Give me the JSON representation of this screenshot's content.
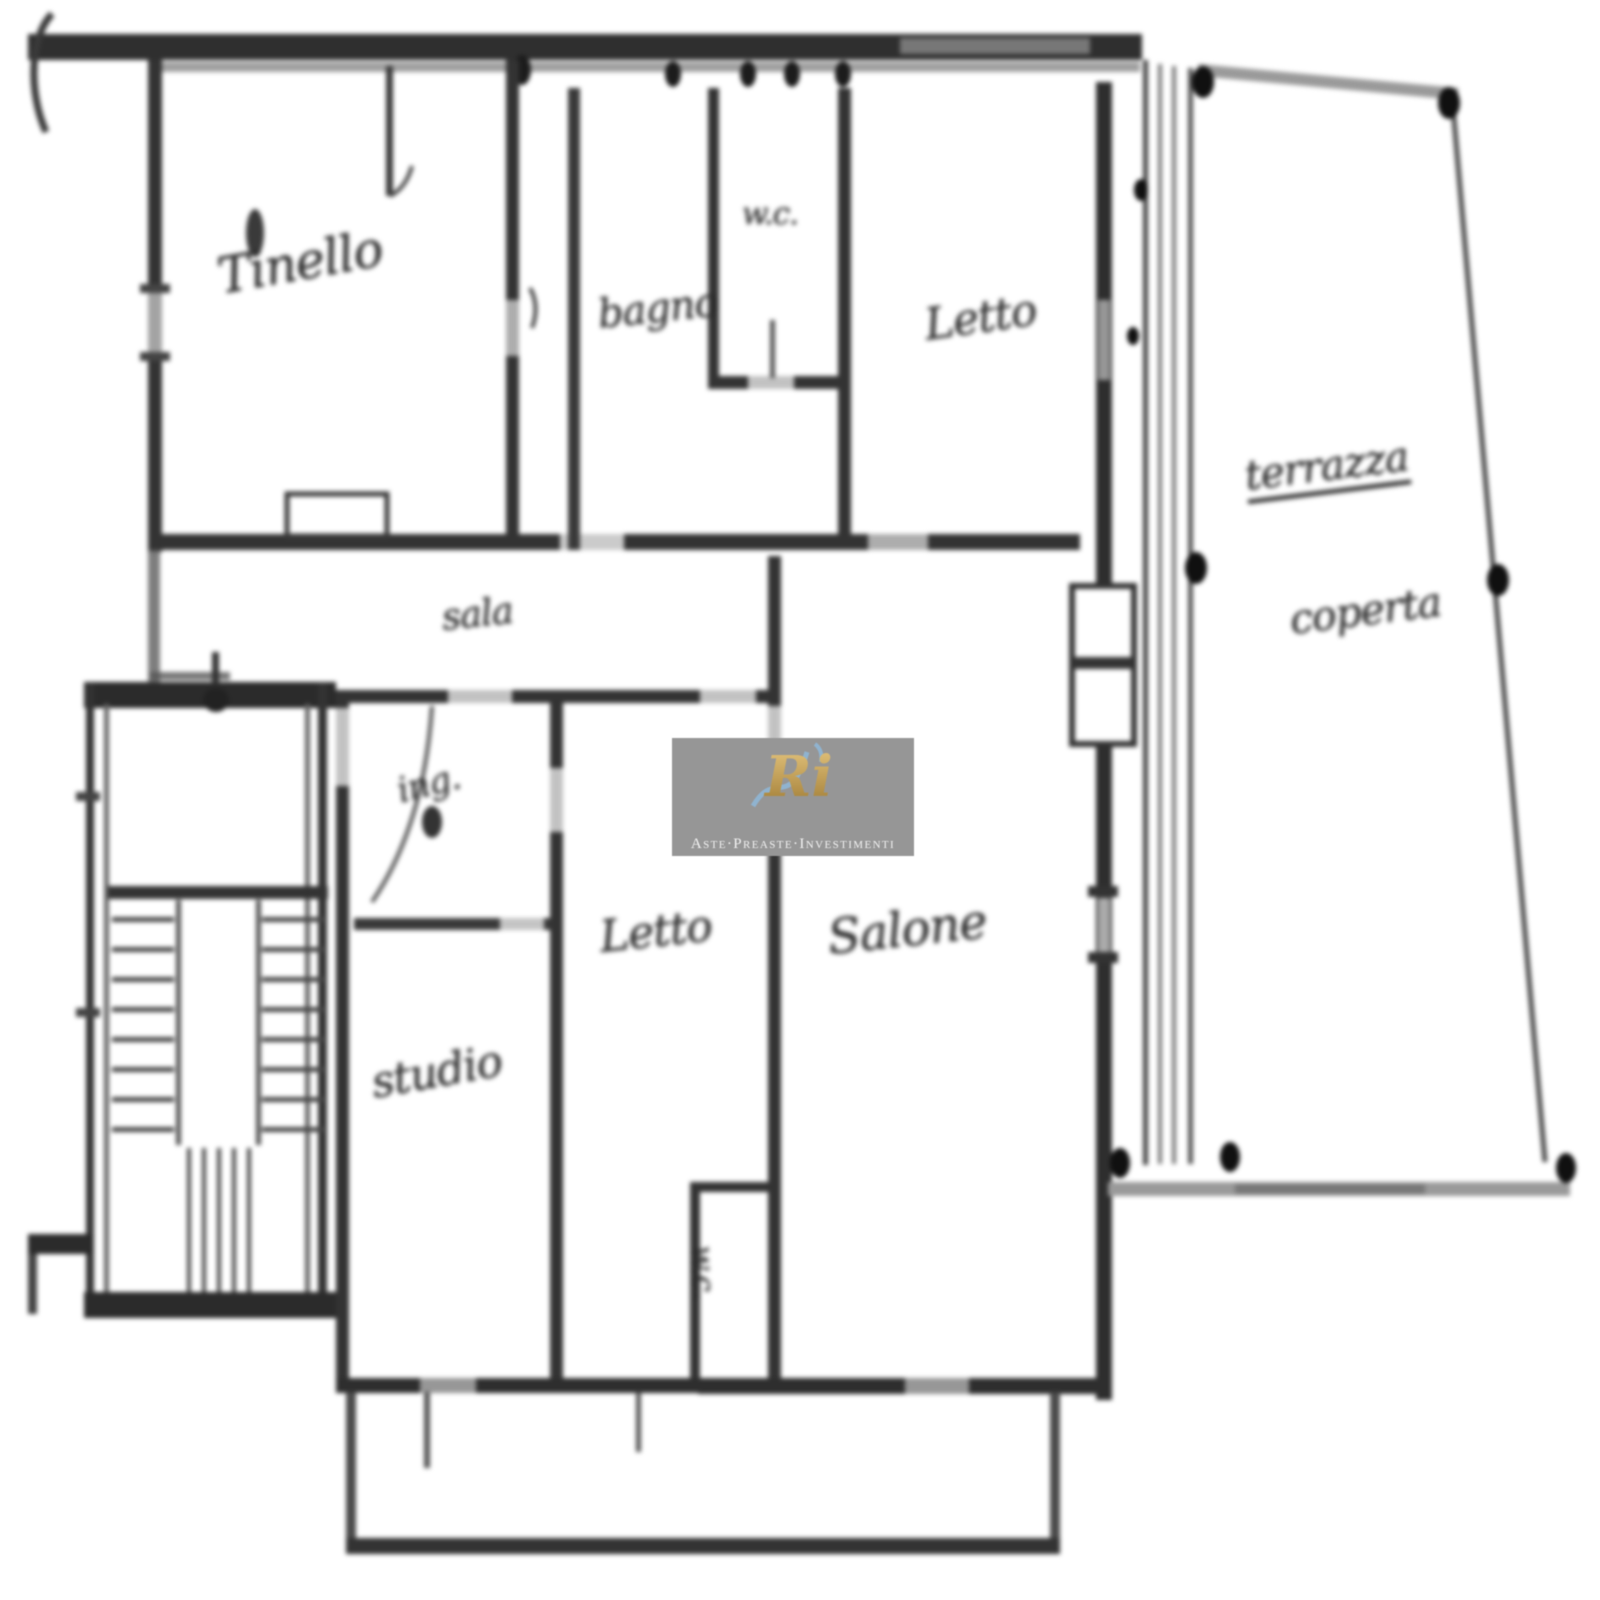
{
  "plan": {
    "rooms": [
      {
        "id": "tinello",
        "label": "Tinello"
      },
      {
        "id": "bagno",
        "label": "bagno"
      },
      {
        "id": "wc-top",
        "label": "w.c."
      },
      {
        "id": "letto-top",
        "label": "Letto"
      },
      {
        "id": "terrazza-line1",
        "label": "terrazza"
      },
      {
        "id": "terrazza-line2",
        "label": "coperta"
      },
      {
        "id": "sala",
        "label": "sala"
      },
      {
        "id": "ingresso",
        "label": "ing."
      },
      {
        "id": "letto-center",
        "label": "Letto"
      },
      {
        "id": "salone",
        "label": "Salone"
      },
      {
        "id": "studio",
        "label": "studio"
      },
      {
        "id": "wc-bottom",
        "label": "w.c."
      }
    ],
    "colors": {
      "background": "#ffffff",
      "wall": "#2b2b2b",
      "light_wall": "#9a9a9a",
      "ink": "#2f2f2f"
    }
  },
  "watermark": {
    "monogram": "Ri",
    "caption": "Aste·Preaste·Investimenti",
    "colors": {
      "box": "#969696",
      "text": "#f2f2f2",
      "gold": "#c8a35a",
      "blue": "#8fb9d9"
    }
  }
}
